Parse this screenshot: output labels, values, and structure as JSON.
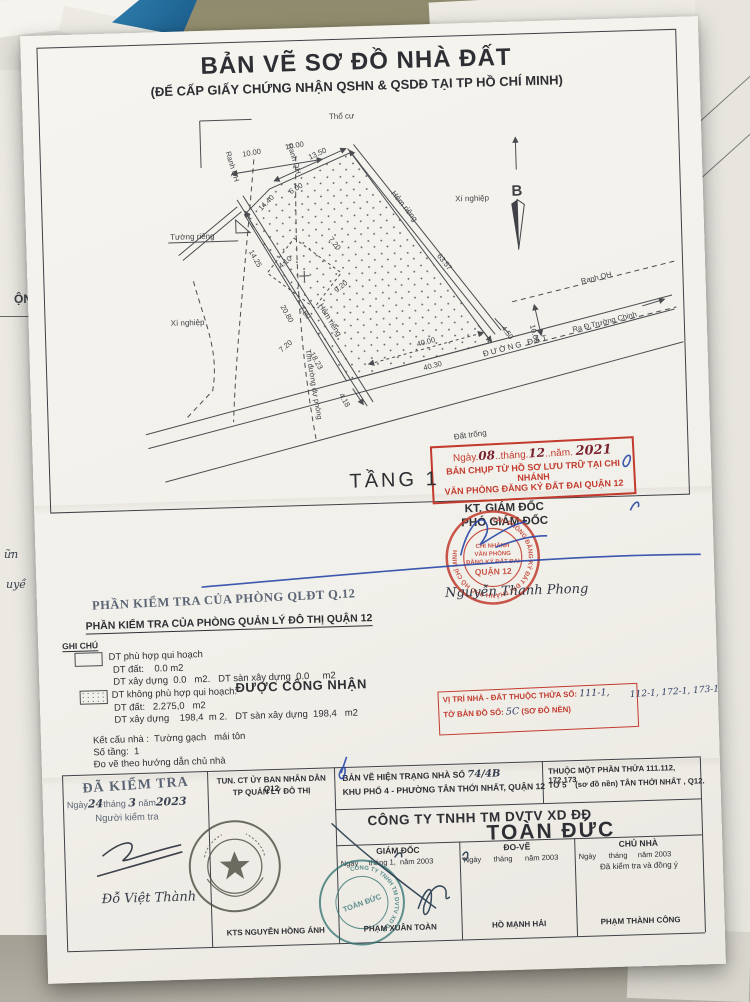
{
  "title": {
    "main": "BẢN VẼ SƠ ĐỒ NHÀ ĐẤT",
    "sub": "(ĐỂ CẤP GIẤY CHỨNG NHẬN QSHN & QSDĐ TẠI TP HỒ CHÍ MINH)"
  },
  "floor_label": "TẦNG 1",
  "drawing": {
    "labels": {
      "tho_cu": "Thổ cư",
      "ranh_qh_a": "Ranh QH",
      "ranh_qh_b": "Ranh QH",
      "ranh_qh_c": "Ranh QH",
      "tuong_rieng": "Tường riêng",
      "hem_rieng_a": "Hẻm riêng",
      "hem_rieng_b": "Hẻm riêng",
      "xi_nghiep_a": "Xí nghiệp",
      "xi_nghiep_b": "Xí nghiệp",
      "tim_duong": "Tim đường dự phóng",
      "duong_dat": "ĐƯỜNG ĐẤT",
      "ra_truong_chinh": "Ra Đ.Trường Chinh",
      "dat_trong": "Đất trống",
      "north": "B"
    },
    "dims": {
      "d10a": "10.00",
      "d10b": "10.00",
      "d1350": "13.50",
      "d600": "6.00",
      "d1440": "14.40",
      "d720a": "7.20",
      "d410": "4.10",
      "d920": "9.20",
      "d780": "7.80",
      "d720b": "7.20",
      "d1425": "14.25",
      "d2080": "20.80",
      "d1823": "18.23",
      "d418": "4.18",
      "d6357": "63.57",
      "d4000": "40.00",
      "d4030": "40.30",
      "d450": "4.50",
      "d1000": "10.00"
    }
  },
  "copy_stamp": {
    "p1": "Ngày.",
    "h1": "08",
    "p2": "..tháng.",
    "h2": "12",
    "p3": "..năm.",
    "h3": "2021",
    "line2": "BẢN CHỤP TỪ HỒ SƠ LƯU TRỮ TẠI CHI NHÁNH",
    "line3": "VĂN PHÒNG ĐĂNG KÝ ĐẤT ĐAI QUẬN 12"
  },
  "approval": {
    "kt": "KT. GIÁM ĐỐC",
    "pho": "PHÓ GIÁM ĐỐC",
    "name": "Nguyễn Thanh Phong",
    "stamp": {
      "ring": "VĂN PHÒNG ĐĂNG KÝ ĐẤT ĐAI THÀNH PHỐ HỒ CHÍ MINH",
      "l1": "CHI NHÁNH",
      "l2": "VĂN PHÒNG",
      "l3": "ĐĂNG KÝ ĐẤT ĐAI",
      "l4": "QUẬN 12"
    }
  },
  "inspection": {
    "stamp_title": "PHẦN KIỂM TRA CỦA PHÒNG QLĐT Q.12",
    "title": "PHẦN KIỂM TRA CỦA PHÒNG QUẢN LÝ ĐÔ THỊ QUẬN 12",
    "note": "GHI CHÚ",
    "fit_label": "DT phù hợp qui hoạch",
    "fit_dat": "DT đất:    0.0 m2",
    "fit_xd": "DT xây dựng  0.0   m2.   DT sàn xây dựng  0.0     m2",
    "unfit_label": "DT không phù hợp qui hoạch:",
    "recognized": "ĐƯỢC CÔNG NHẬN",
    "unfit_dat": "DT đất:   2.275,0   m2",
    "unfit_xd": "DT xây dựng    198,4  m 2.   DT sàn xây dựng  198,4   m2",
    "structure": "Kết cấu nhà :  Tường gạch   mái tôn",
    "floors": "Số tầng:  1",
    "note2": "Đo vẽ theo hướng dẫn chủ nhà"
  },
  "location_stamp": {
    "line1": "VỊ TRÍ NHÀ - ĐẤT THUỘC THỬA SỐ:",
    "hand_in": "111-1,",
    "hand_out": "112-1, 172-1, 173-1",
    "line2_pre": "TỜ BẢN ĐỒ SỐ:",
    "hand2": "5C",
    "line2_suf": "(SƠ ĐỒ NỀN)"
  },
  "table": {
    "checked": "ĐÃ KIỂM TRA",
    "cd_p1": "Ngày",
    "cd_h1": "24",
    "cd_p2": "tháng",
    "cd_h2": "3",
    "cd_p3": "năm",
    "cd_h3": "2023",
    "checker": "Người kiểm tra",
    "checker_name": "Đỗ Việt Thành",
    "auth1": "TUN. CT ỦY BAN NHÂN DÂN Q12",
    "auth2": "TP QUẢN LÝ ĐÔ THỊ",
    "arch": "KTS NGUYỄN HỒNG ÁNH",
    "bv1_pre": "BẢN VẼ HIỆN TRẠNG NHÀ SỐ",
    "bv1_hand": "74/4B",
    "bv2": "KHU PHỐ 4 - PHƯỜNG TÂN THỚI NHẤT, QUẬN 12",
    "p1": "THUỘC MỘT PHẦN THỬA 111.112, 172.173",
    "p2": "TỜ 5    (sơ đồ nền) TÂN THỚI NHẤT , Q12.",
    "company": "CÔNG TY TNHH TM DVTV XD ĐĐ",
    "company_big": "TOÀN ĐỨC",
    "h_gd": "GIÁM ĐỐC",
    "h_dv": "ĐO-VẼ",
    "h_cn": "CHỦ NHÀ",
    "gd_date": "Ngày     tháng 1,  năm 2003",
    "dv_date": "Ngày      tháng      năm 2003",
    "cn_date": "Ngày      tháng     năm 2003",
    "cn_note": "Đã kiểm tra và đồng ý",
    "n_gd": "PHẠM XUÂN TOÀN",
    "n_dv": "HỒ MẠNH HẢI",
    "n_cn": "PHẠM THÀNH CÔNG"
  },
  "company_stamp": {
    "ring": "CÔNG TY TNHH TM DVTV XD ĐĐ",
    "center": "TOÀN ĐỨC"
  },
  "surroundings": {
    "left_frag": "ỘN",
    "left_hand1": "ữn",
    "left_hand2": "uyề",
    "r1": "Xóa nội dung",
    "r2": "o theo hồ sơ số",
    "r3": "Nội du",
    "r4": "VT-"
  }
}
